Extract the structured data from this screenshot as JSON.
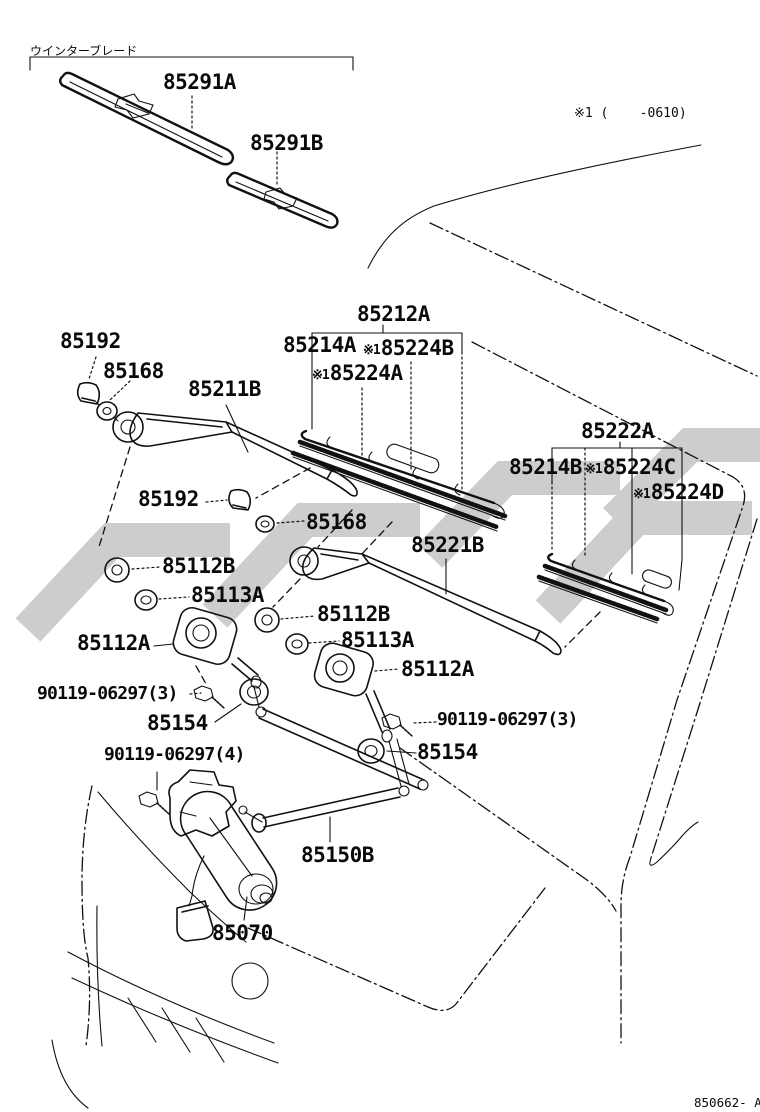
{
  "page": {
    "group_note": "ウインターブレード",
    "variant_note": "※1 (    -0610)",
    "figure_code": "850662- A"
  },
  "callouts": [
    {
      "text": "85291A"
    },
    {
      "text": "85291B"
    },
    {
      "text": "85212A"
    },
    {
      "text": "85214A"
    },
    {
      "prefix": "※1",
      "text": "85224B"
    },
    {
      "prefix": "※1",
      "text": "85224A"
    },
    {
      "text": "85211B"
    },
    {
      "text": "85192"
    },
    {
      "text": "85168"
    },
    {
      "text": "85192"
    },
    {
      "text": "85168"
    },
    {
      "text": "85222A"
    },
    {
      "text": "85214B"
    },
    {
      "prefix": "※1",
      "text": "85224C"
    },
    {
      "prefix": "※1",
      "text": "85224D"
    },
    {
      "text": "85221B"
    },
    {
      "text": "85112B"
    },
    {
      "text": "85113A"
    },
    {
      "text": "85112B"
    },
    {
      "text": "85113A"
    },
    {
      "text": "85112A"
    },
    {
      "text": "85112A"
    },
    {
      "text": "90119-06297(3)"
    },
    {
      "text": "85154"
    },
    {
      "text": "90119-06297(3)"
    },
    {
      "text": "85154"
    },
    {
      "text": "90119-06297(4)"
    },
    {
      "text": "85150B"
    },
    {
      "text": "85070"
    }
  ]
}
